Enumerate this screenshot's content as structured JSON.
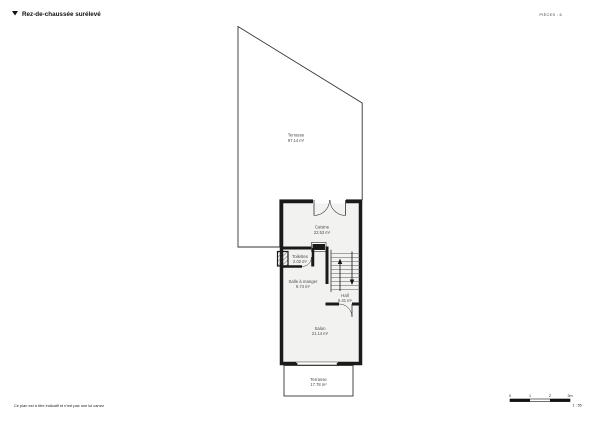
{
  "header": {
    "title": "Rez-de-chaussée surélevé",
    "pieces_label": "PIÈCES : 6"
  },
  "rooms": {
    "terrasse_top": {
      "name": "Terrasse",
      "area": "97.14 m²"
    },
    "cuisine": {
      "name": "Cuisine",
      "area": "22.53 m²"
    },
    "toilettes": {
      "name": "Toilettes",
      "area": "2.02 m²"
    },
    "salle_a_manger": {
      "name": "Salle à manger",
      "area": "9.74 m²"
    },
    "hall": {
      "name": "Hall",
      "area": "6.41 m²"
    },
    "salon": {
      "name": "Salon",
      "area": "21.14 m²"
    },
    "terrasse_bottom": {
      "name": "Terrasse",
      "area": "17.78 m²"
    }
  },
  "footer": {
    "disclaimer": "Ce plan est à titre indicatif et n'est pas une loi carrez",
    "scale": {
      "ticks": [
        "0",
        "1",
        "2",
        "3m"
      ],
      "ratio": "1 : 55"
    }
  },
  "colors": {
    "wall": "#1a1a1a",
    "interior_fill": "#f2f2f0",
    "outline": "#333333",
    "label_text": "#4a4a4a"
  }
}
